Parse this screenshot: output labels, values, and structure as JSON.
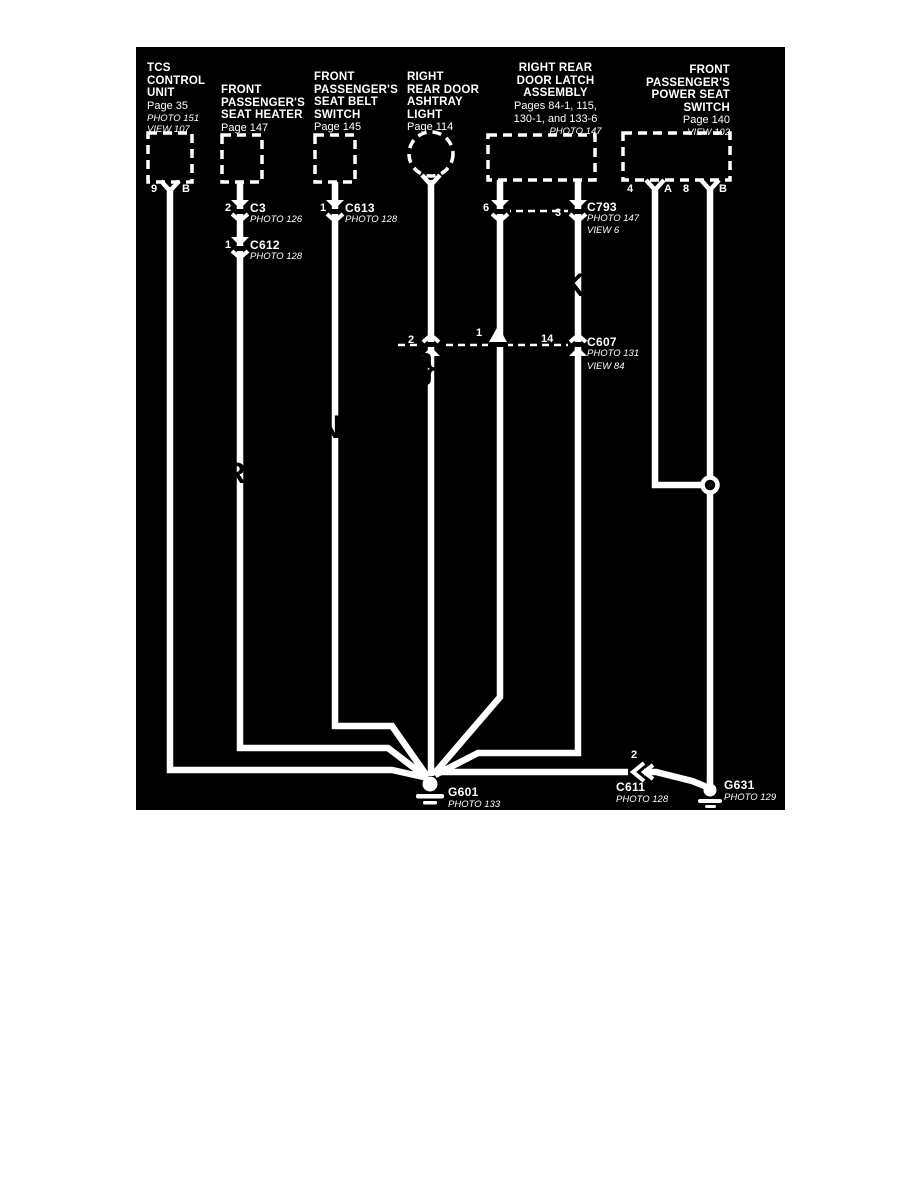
{
  "panel": {
    "bg": "#000000",
    "fg": "#ffffff"
  },
  "components": {
    "tcs": {
      "title": "TCS\nCONTROL\nUNIT",
      "page": "Page 35",
      "photo": "PHOTO 151",
      "view": "VIEW 107",
      "pin_left": "9",
      "pin_right": "B"
    },
    "seat_heater": {
      "title": "FRONT\nPASSENGER'S\nSEAT HEATER",
      "page": "Page 147"
    },
    "seat_belt": {
      "title": "FRONT\nPASSENGER'S\nSEAT BELT\nSWITCH",
      "page": "Page 145"
    },
    "ashtray": {
      "title": "RIGHT\nREAR DOOR\nASHTRAY\nLIGHT",
      "page": "Page 114"
    },
    "door_latch": {
      "title": "RIGHT REAR\nDOOR LATCH\nASSEMBLY",
      "pages": "Pages 84-1, 115,\n130-1, and 133-6",
      "photo": "PHOTO 147"
    },
    "power_seat": {
      "title": "FRONT\nPASSENGER'S\nPOWER SEAT\nSWITCH",
      "page": "Page 140",
      "view": "VIEW 102",
      "pins": {
        "p1_num": "4",
        "p1_letter": "A",
        "p2_num": "8",
        "p2_letter": "B"
      }
    }
  },
  "connectors": {
    "c3": {
      "name": "C3",
      "pin": "2",
      "photo": "PHOTO 126"
    },
    "c612": {
      "name": "C612",
      "pin": "1",
      "photo": "PHOTO 128"
    },
    "c613": {
      "name": "C613",
      "pin": "1",
      "photo": "PHOTO 128"
    },
    "c793": {
      "name": "C793",
      "pin_left": "6",
      "pin_right": "3",
      "photo": "PHOTO 147",
      "view": "VIEW 6"
    },
    "c607": {
      "name": "C607",
      "pin_left": "2",
      "pin_mid": "1",
      "pin_right": "14",
      "photo": "PHOTO 131",
      "view": "VIEW 84"
    },
    "c611": {
      "name": "C611",
      "pin": "2",
      "photo": "PHOTO 128"
    }
  },
  "grounds": {
    "g601": {
      "name": "G601",
      "photo": "PHOTO 133"
    },
    "g631": {
      "name": "G631",
      "photo": "PHOTO 129"
    }
  },
  "artifacts": {
    "m1": "R",
    "m2": "N",
    "m3": "}",
    "m4": "K"
  }
}
